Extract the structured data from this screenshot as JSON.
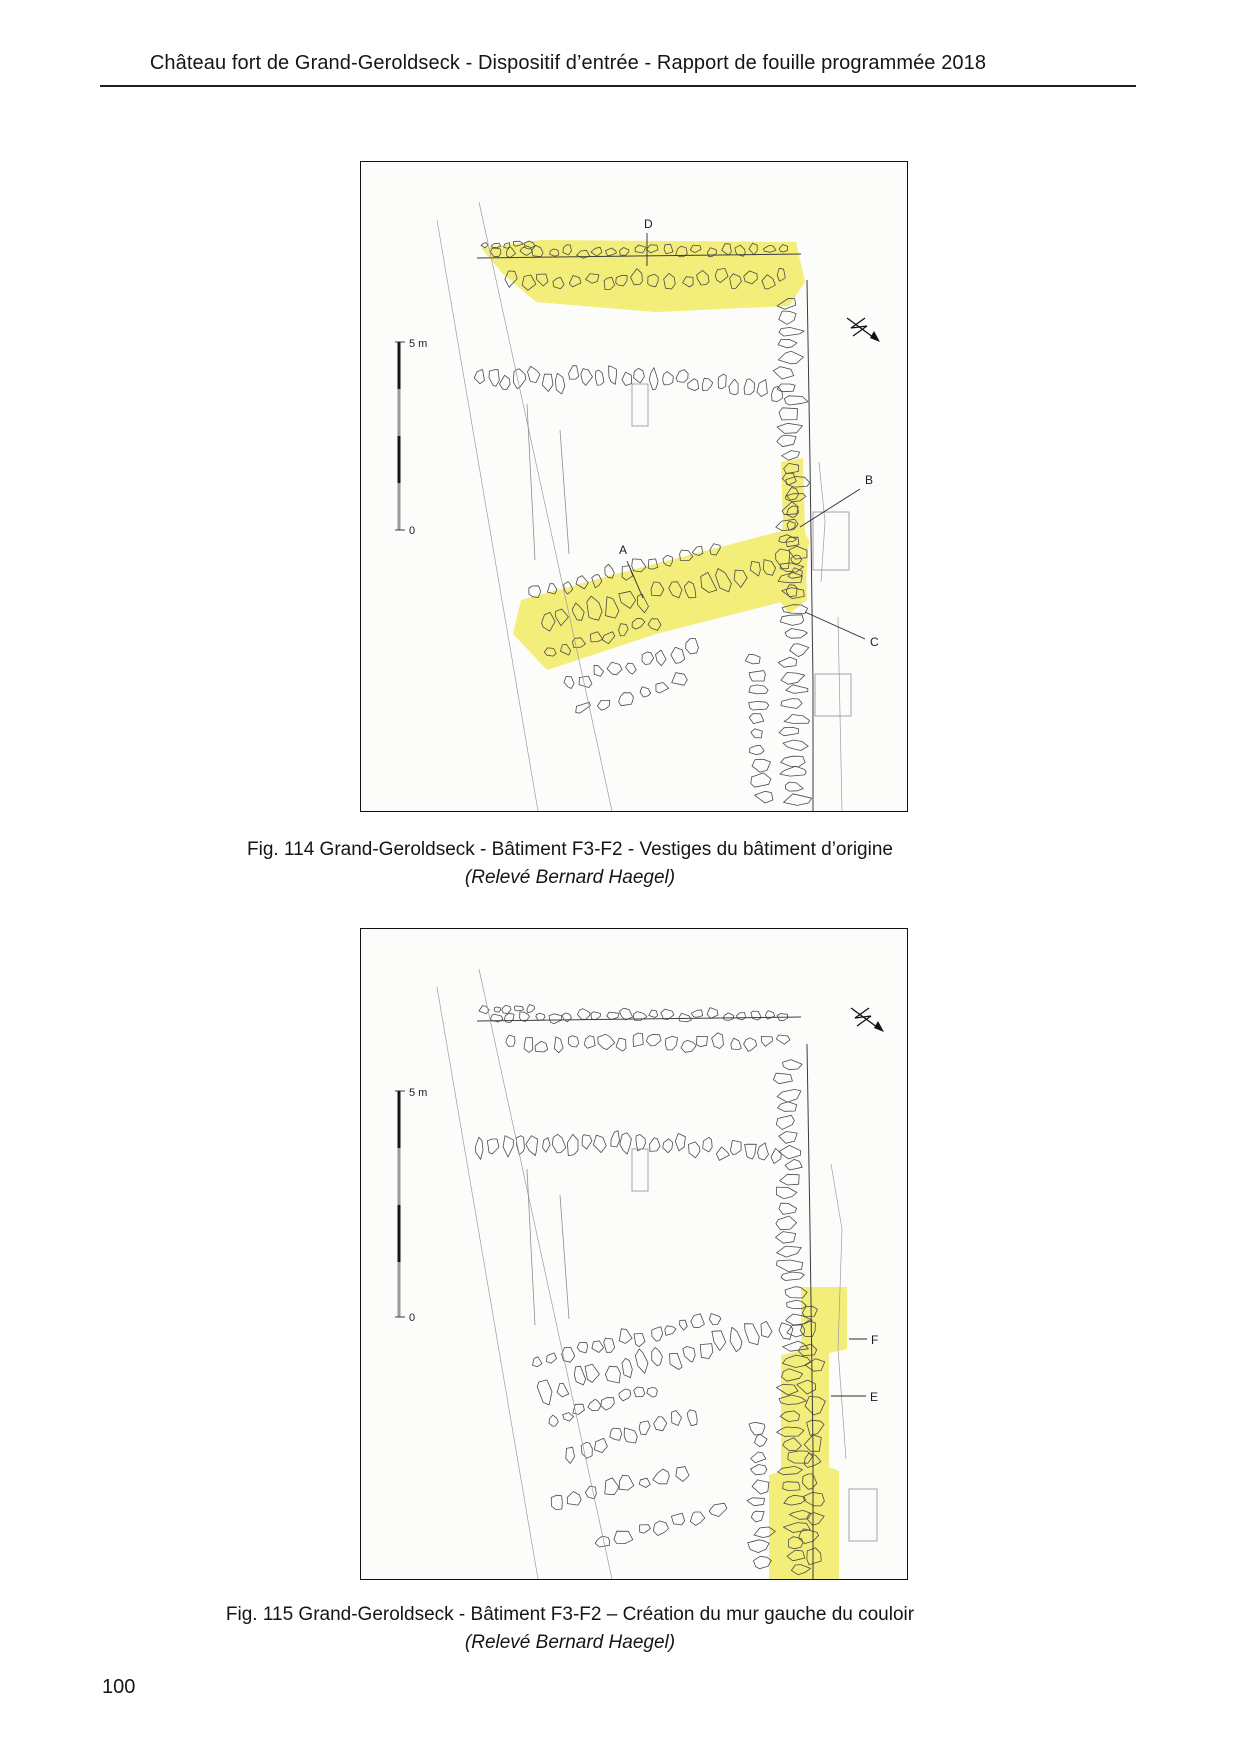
{
  "header": {
    "title": "Château fort de Grand-Geroldseck - Dispositif d’entrée - Rapport de fouille programmée 2018"
  },
  "figures": [
    {
      "caption": "Fig. 114 Grand-Geroldseck - Bâtiment F3-F2 - Vestiges du bâtiment d’origine",
      "credit": "(Relevé Bernard Haegel)",
      "labels": {
        "d": "D",
        "a": "A",
        "b": "B",
        "c": "C"
      },
      "scale": {
        "top": "5 m",
        "bottom": "0"
      }
    },
    {
      "caption": "Fig. 115 Grand-Geroldseck - Bâtiment F3-F2 – Création du mur gauche du couloir",
      "credit": "(Relevé Bernard Haegel)",
      "labels": {
        "f": "F",
        "e": "E"
      },
      "scale": {
        "top": "5 m",
        "bottom": "0"
      }
    }
  ],
  "footer": {
    "page_number": "100"
  },
  "colors": {
    "highlight": "#f3ed7a"
  }
}
